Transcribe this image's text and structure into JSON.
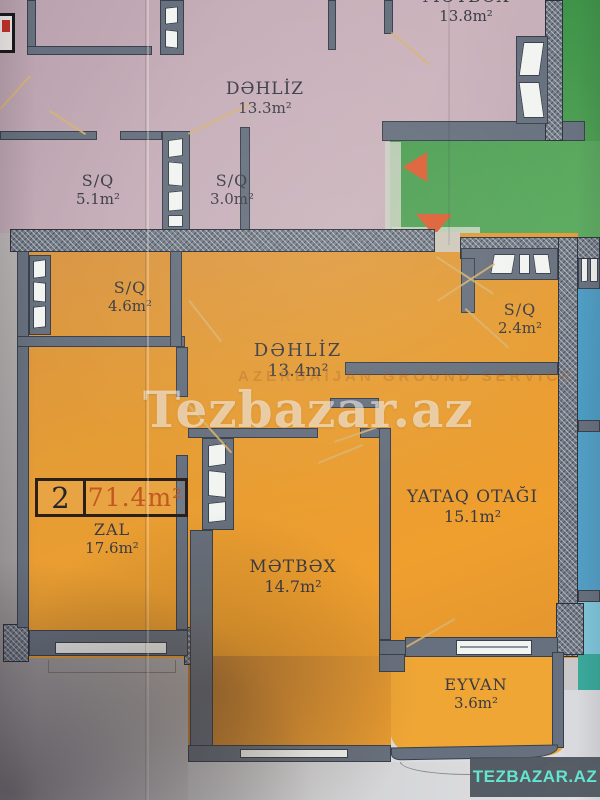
{
  "photo": {
    "watermark": "Tezbazar.az",
    "watermark_faint": "AZERBAIJAN GROUND SERVICE",
    "logo_text": "TEZBAZAR.AZ"
  },
  "listing_badge": {
    "number": "2",
    "total_area": "71.4m²"
  },
  "rooms": {
    "top_metbex": {
      "name": "MƏTBƏX",
      "area": "13.8m²"
    },
    "top_dehliz": {
      "name": "DƏHLİZ",
      "area": "13.3m²"
    },
    "top_sq_1": {
      "name": "S/Q",
      "area": "5.1m²"
    },
    "top_sq_2": {
      "name": "S/Q",
      "area": "3.0m²"
    },
    "sq_46": {
      "name": "S/Q",
      "area": "4.6m²"
    },
    "dehliz": {
      "name": "DƏHLİZ",
      "area": "13.4m²"
    },
    "sq_24": {
      "name": "S/Q",
      "area": "2.4m²"
    },
    "zal": {
      "name": "ZAL",
      "area": "17.6m²"
    },
    "metbex": {
      "name": "MƏTBƏX",
      "area": "14.7m²"
    },
    "yataq": {
      "name": "YATAQ OTAĞI",
      "area": "15.1m²"
    },
    "eyvan": {
      "name": "EYVAN",
      "area": "3.6m²"
    }
  },
  "colors": {
    "unit_highlight_orange": "#e49c38",
    "unit_neighbor_pink": "#c3abb5",
    "unit_neighbor_blue": "#4d9dc4",
    "common_area_green": "#52a156",
    "wall_gray": "#67707e",
    "badge_area_text": "#c2571f",
    "direction_arrow_orange": "#dd5f35",
    "logo_teal": "#63e6d1"
  }
}
